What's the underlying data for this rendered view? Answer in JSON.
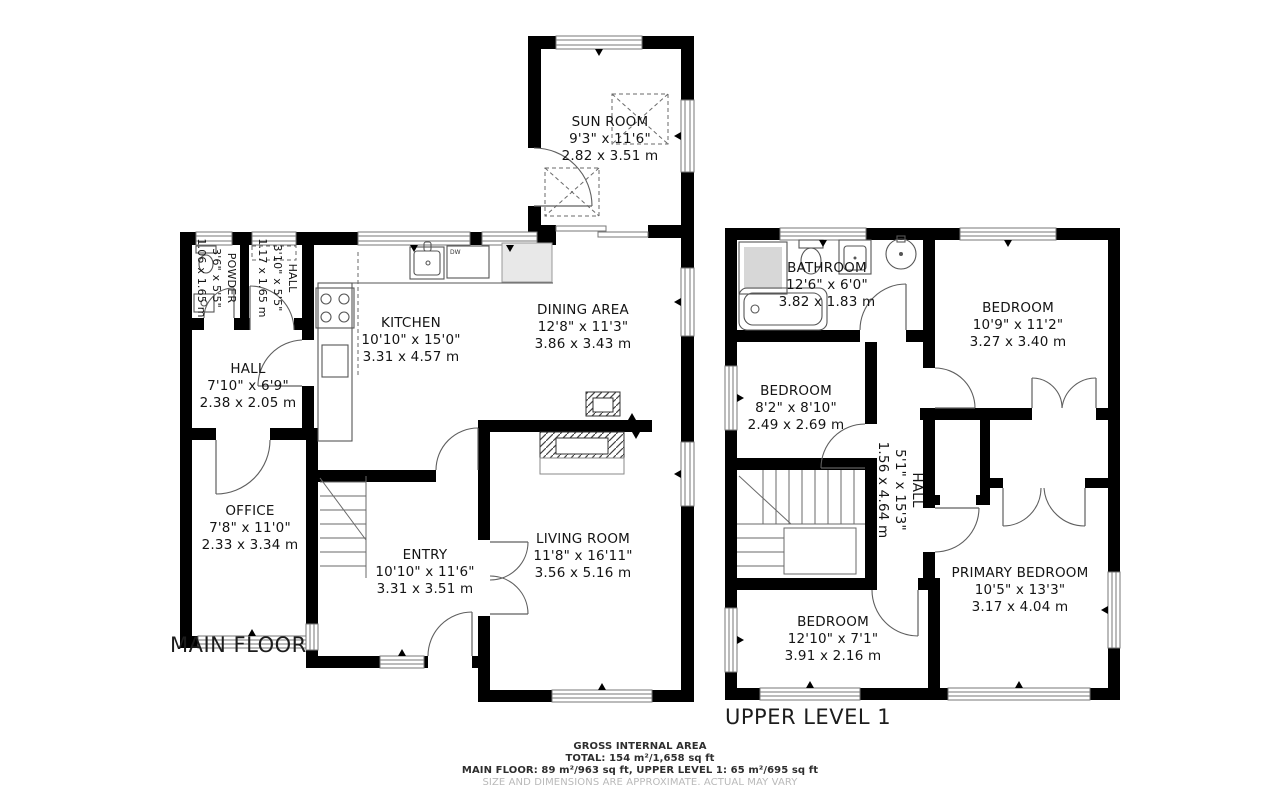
{
  "floors": [
    {
      "label": "MAIN FLOOR",
      "rooms": [
        {
          "name": "SUN ROOM",
          "imperial": "9'3\" x 11'6\"",
          "metric": "2.82 x 3.51 m"
        },
        {
          "name": "POWDER",
          "imperial": "3'6\" x 5'5\"",
          "metric": "1.06 x 1.65 m"
        },
        {
          "name": "HALL",
          "imperial": "3'10\" x 5'5\"",
          "metric": "1.17 x 1.65 m"
        },
        {
          "name": "KITCHEN",
          "imperial": "10'10\" x 15'0\"",
          "metric": "3.31 x 4.57 m"
        },
        {
          "name": "DINING AREA",
          "imperial": "12'8\" x 11'3\"",
          "metric": "3.86 x 3.43 m"
        },
        {
          "name": "HALL",
          "imperial": "7'10\" x 6'9\"",
          "metric": "2.38 x 2.05 m"
        },
        {
          "name": "OFFICE",
          "imperial": "7'8\" x 11'0\"",
          "metric": "2.33 x 3.34 m"
        },
        {
          "name": "ENTRY",
          "imperial": "10'10\" x 11'6\"",
          "metric": "3.31 x 3.51 m"
        },
        {
          "name": "LIVING ROOM",
          "imperial": "11'8\" x 16'11\"",
          "metric": "3.56 x 5.16 m"
        }
      ]
    },
    {
      "label": "UPPER LEVEL 1",
      "rooms": [
        {
          "name": "BATHROOM",
          "imperial": "12'6\" x 6'0\"",
          "metric": "3.82 x 1.83 m"
        },
        {
          "name": "BEDROOM",
          "imperial": "10'9\" x 11'2\"",
          "metric": "3.27 x 3.40 m"
        },
        {
          "name": "BEDROOM",
          "imperial": "8'2\" x 8'10\"",
          "metric": "2.49 x 2.69 m"
        },
        {
          "name": "HALL",
          "imperial": "5'1\" x 15'3\"",
          "metric": "1.56 x 4.64 m"
        },
        {
          "name": "BEDROOM",
          "imperial": "12'10\" x 7'1\"",
          "metric": "3.91 x 2.16 m"
        },
        {
          "name": "PRIMARY BEDROOM",
          "imperial": "10'5\" x 13'3\"",
          "metric": "3.17 x 4.04 m"
        }
      ]
    }
  ],
  "fixtures": {
    "dishwasher_label": "DW"
  },
  "footer": {
    "line1": "GROSS INTERNAL AREA",
    "line2": "TOTAL: 154 m²/1,658 sq ft",
    "line3": "MAIN FLOOR: 89 m²/963 sq ft, UPPER LEVEL 1: 65 m²/695 sq ft",
    "line4": "SIZE AND DIMENSIONS ARE APPROXIMATE. ACTUAL MAY VARY"
  },
  "colors": {
    "wall": "#000000",
    "fixture_line": "#565656",
    "text": "#141414",
    "muted_text": "#b9b9b9",
    "background": "#ffffff"
  }
}
